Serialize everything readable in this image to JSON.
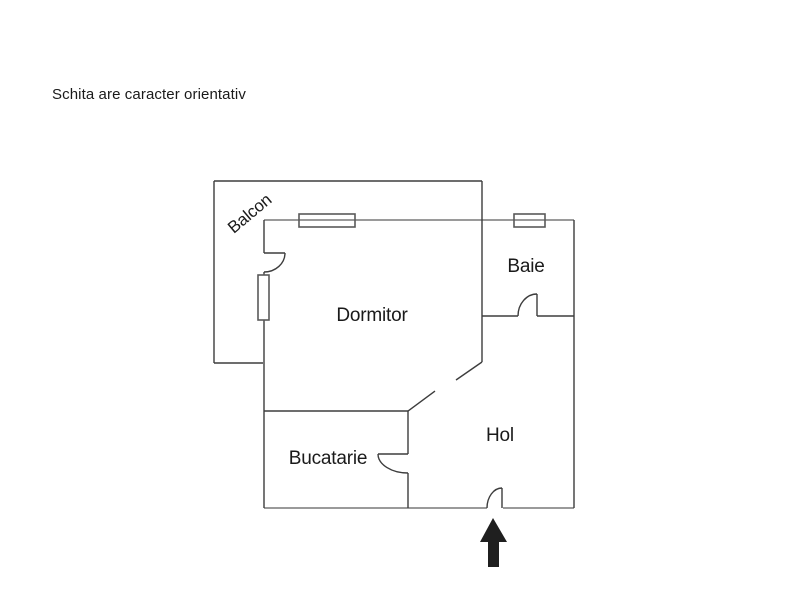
{
  "title": "Schita are caracter orientativ",
  "floor_plan": {
    "rooms": [
      {
        "name": "Balcon"
      },
      {
        "name": "Dormitor"
      },
      {
        "name": "Baie"
      },
      {
        "name": "Bucatarie"
      },
      {
        "name": "Hol"
      }
    ],
    "features": {
      "windows": [
        {
          "location": "dormitor-top-wall"
        },
        {
          "location": "baie-top-wall"
        },
        {
          "location": "dormitor-left-wall-to-balcon"
        }
      ],
      "doors": [
        {
          "location": "balcon-to-dormitor"
        },
        {
          "location": "baie-to-hol"
        },
        {
          "location": "bucatarie-to-hol"
        },
        {
          "location": "dormitor-to-hol-diagonal-opening"
        },
        {
          "location": "entrance-bottom-of-hol"
        }
      ],
      "entrance_arrow": "up-arrow"
    },
    "colors": {
      "wall": "#3d3d3d",
      "exterior_wall": "#9a9a9a",
      "window_outline": "#5a5a5a",
      "arrow": "#1f1f1f",
      "arrow_outline": "#c9c9c9",
      "text": "#1a1a1a",
      "background": "#ffffff"
    }
  }
}
